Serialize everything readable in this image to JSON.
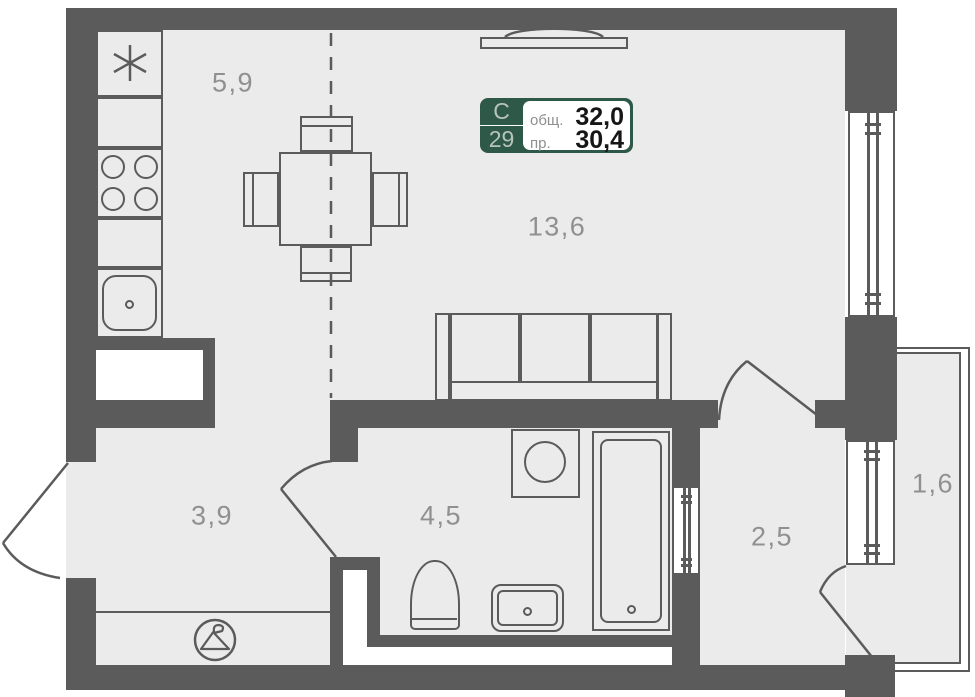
{
  "unit_badge": {
    "section_letter": "С",
    "unit_number": "29",
    "total_area_label": "общ.",
    "total_area_value": "32,0",
    "living_area_label": "пр.",
    "living_area_value": "30,4"
  },
  "rooms": {
    "kitchen": {
      "area": "5,9"
    },
    "living": {
      "area": "13,6"
    },
    "hall": {
      "area": "3,9"
    },
    "bathroom": {
      "area": "4,5"
    },
    "corridor": {
      "area": "2,5"
    },
    "balcony": {
      "area": "1,6"
    }
  },
  "colors": {
    "wall": "#5b5b5b",
    "floor": "#ebebeb",
    "badge_green": "#2e5847",
    "badge_light_text": "#b7c4bb",
    "label_gray": "#909090"
  },
  "icons": [
    "fridge-asterisk-icon",
    "hanger-icon",
    "stove-burner-icon",
    "tv-icon"
  ]
}
